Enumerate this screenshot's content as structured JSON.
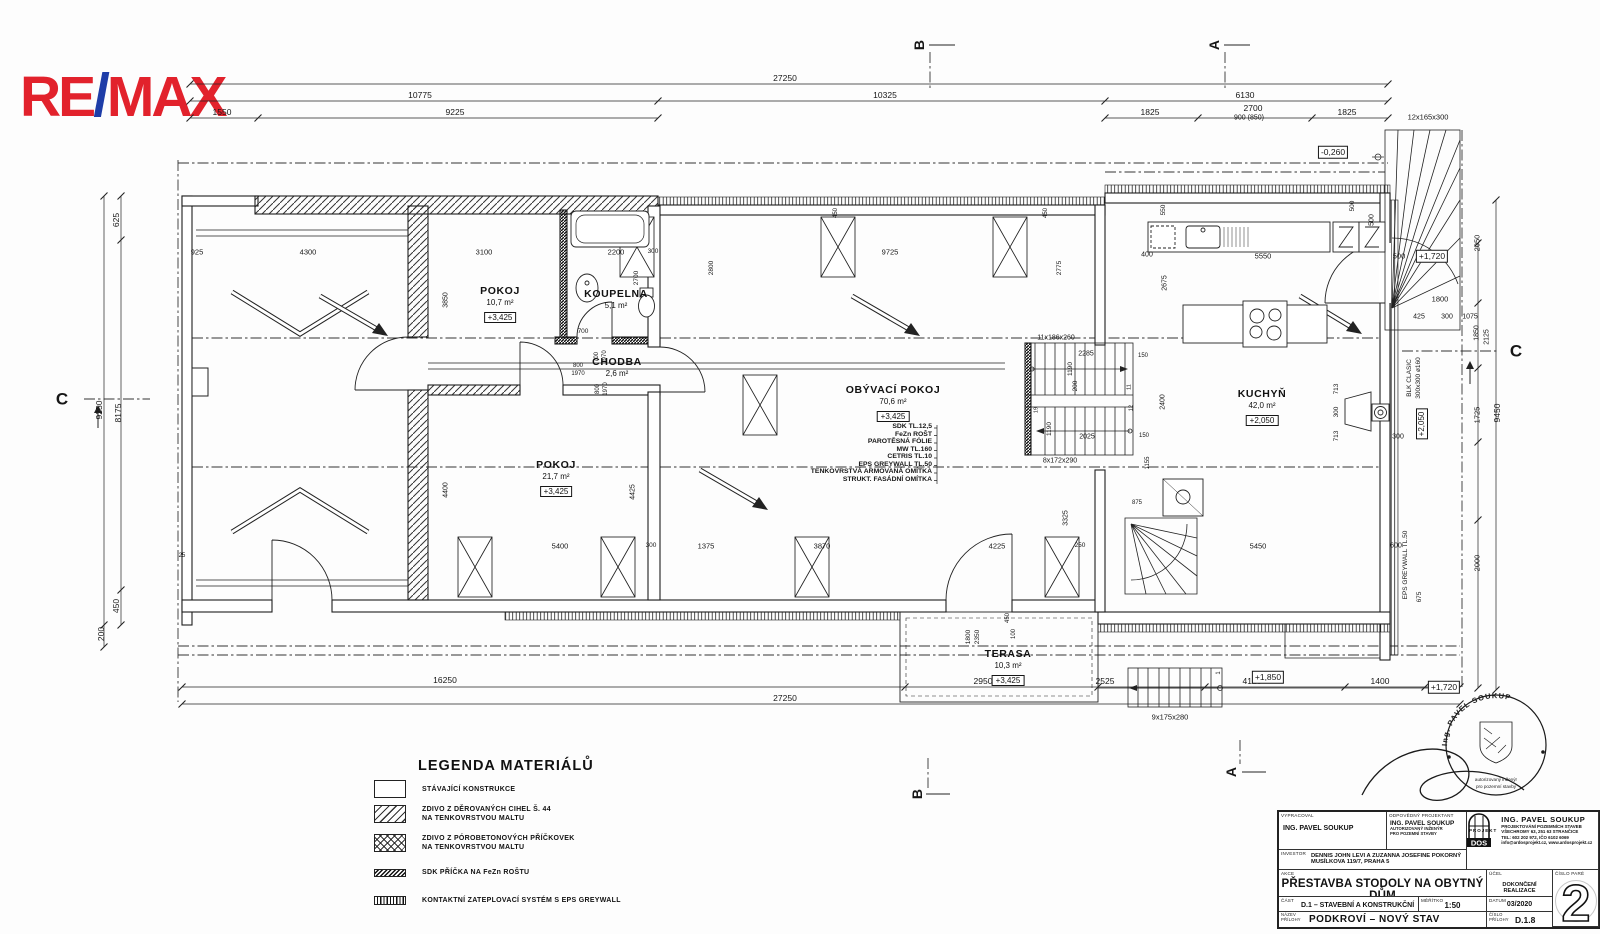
{
  "logo": {
    "re": "RE",
    "slash": "/",
    "max": "MAX",
    "red": "#e2222c",
    "blue": "#1e3da8"
  },
  "legend": {
    "title": "LEGENDA MATERIÁLŮ",
    "items": [
      {
        "swatch": "plain",
        "line1": "STÁVAJÍCÍ KONSTRUKCE",
        "line2": ""
      },
      {
        "swatch": "diag",
        "line1": "ZDIVO Z DĚROVANÝCH CIHEL Š. 44",
        "line2": "NA TENKOVRSTVOU MALTU"
      },
      {
        "swatch": "cross",
        "line1": "ZDIVO Z PÓROBETONOVÝCH PŘÍČKOVEK",
        "line2": "NA TENKOVRSTVOU MALTU"
      },
      {
        "swatch": "sdk",
        "line1": "SDK PŘÍČKA NA FeZn ROŠTU",
        "line2": ""
      },
      {
        "swatch": "eps",
        "line1": "KONTAKTNÍ ZATEPLOVACÍ SYSTÉM S EPS GREYWALL",
        "line2": ""
      }
    ]
  },
  "title_block": {
    "lbl_vypracoval": "VYPRACOVAL",
    "vypracoval": "ING. PAVEL SOUKUP",
    "lbl_odpovedny": "ODPOVĚDNÝ PROJEKTANT",
    "odpovedny": "ING. PAVEL SOUKUP",
    "odpovedny_note1": "AUTORIZOVANÝ INŽENÝR",
    "odpovedny_note2": "PRO POZEMNÍ STAVBY",
    "lbl_investor": "INVESTOR",
    "investor1": "DENNIS JOHN LEVI A ZUZANNA JOSEFINE POKORNÝ",
    "investor2": "MUSÍLKOVA 119/7, PRAHA 5",
    "lbl_akce": "AKCE",
    "akce": "PŘESTAVBA STODOLY NA OBYTNÝ DŮM",
    "akce_sub": "KOSTELNÍ STŘÍMELICE č.p. 12, parc.č. st.12",
    "lbl_ucel": "ÚČEL",
    "ucel": "DOKONČENÍ REALIZACE",
    "lbl_cast": "ČÁST",
    "cast": "D.1 – STAVEBNÍ A KONSTRUKČNÍ",
    "lbl_meritko": "MĚŘÍTKO",
    "meritko": "1:50",
    "lbl_datum": "DATUM",
    "datum": "03/2020",
    "lbl_nazev1": "NÁZEV",
    "lbl_nazev2": "PŘÍLOHY",
    "nazev": "PODKROVÍ – NOVÝ STAV",
    "lbl_cislo1": "ČÍSLO",
    "lbl_cislo2": "PŘÍLOHY",
    "cislo": "D.1.8",
    "lbl_pare": "ČÍSLO PARÉ",
    "pare": "2",
    "dos": {
      "logo_top": "DOS",
      "logo_bottom": "PROJEKT",
      "name": "ING. PAVEL SOUKUP",
      "l1": "PROJEKTOVÁNÍ POZEMNÍCH STAVEB",
      "l2": "VŠECHROMY 63, 251 63 STRANČICE",
      "l3": "TEL: 602 202 972, IČO 6102 6069",
      "l4": "info@ardosprojekt.cz, www.ardosprojekt.cz"
    }
  },
  "stamp": {
    "arc": "Ing. PAVEL SOUKUP",
    "line1": "autorizovaný inženýr",
    "line2": "pro pozemní stavby"
  },
  "plan": {
    "layers": [
      "SDK TL.12,5",
      "FeZn ROŠT",
      "PAROTĚSNÁ FÓLIE",
      "MW TL.160",
      "CETRIS TL.10",
      "EPS GREYWALL TL.50",
      "TENKOVRSTVÁ ARMOVANÁ OMÍTKA",
      "STRUKT. FASÁDNÍ OMÍTKA"
    ],
    "rooms": [
      {
        "name": "POKOJ",
        "area": "10,7 m²",
        "level": "+3,425",
        "x": 500,
        "y": 291
      },
      {
        "name": "KOUPELNA",
        "area": "5,1 m²",
        "level": "",
        "x": 616,
        "y": 294
      },
      {
        "name": "CHODBA",
        "area": "2,6 m²",
        "level": "",
        "x": 617,
        "y": 362
      },
      {
        "name": "POKOJ",
        "area": "21,7 m²",
        "level": "+3,425",
        "x": 556,
        "y": 465
      },
      {
        "name": "OBÝVACÍ POKOJ",
        "area": "70,6 m²",
        "level": "+3,425",
        "x": 893,
        "y": 390
      },
      {
        "name": "KUCHYŇ",
        "area": "42,0 m²",
        "level": "+2,050",
        "x": 1262,
        "y": 394
      },
      {
        "name": "TERASA",
        "area": "10,3 m²",
        "level": "+3,425",
        "x": 1008,
        "y": 654
      }
    ],
    "labels": [
      {
        "t": "27250",
        "x": 785,
        "y": 78
      },
      {
        "t": "10775",
        "x": 420,
        "y": 95
      },
      {
        "t": "10325",
        "x": 885,
        "y": 95
      },
      {
        "t": "6130",
        "x": 1245,
        "y": 95
      },
      {
        "t": "1550",
        "x": 222,
        "y": 112
      },
      {
        "t": "9225",
        "x": 455,
        "y": 112
      },
      {
        "t": "1825",
        "x": 1150,
        "y": 112
      },
      {
        "t": "2700",
        "x": 1253,
        "y": 108
      },
      {
        "t": "900 (850)",
        "x": 1249,
        "y": 118,
        "fs": 7
      },
      {
        "t": "1825",
        "x": 1347,
        "y": 112
      },
      {
        "t": "12x165x300",
        "x": 1428,
        "y": 117,
        "fs": 7.5
      },
      {
        "t": "-0,260",
        "x": 1333,
        "y": 152,
        "b": 1
      },
      {
        "t": "B",
        "x": 919,
        "y": 45,
        "r": 1,
        "bold": 1,
        "fs": 14,
        "n": "section-marker-b-top"
      },
      {
        "t": "A",
        "x": 1214,
        "y": 45,
        "r": 1,
        "bold": 1,
        "fs": 14,
        "n": "section-marker-a-top"
      },
      {
        "t": "A",
        "x": 1231,
        "y": 772,
        "r": 1,
        "bold": 1,
        "fs": 14,
        "n": "section-marker-a-bottom"
      },
      {
        "t": "B",
        "x": 917,
        "y": 794,
        "r": 1,
        "bold": 1,
        "fs": 14,
        "n": "section-marker-b-bottom"
      },
      {
        "t": "C",
        "x": 62,
        "y": 399,
        "bold": 1,
        "fs": 17,
        "n": "section-marker-c-left"
      },
      {
        "t": "C",
        "x": 1516,
        "y": 351,
        "bold": 1,
        "fs": 17,
        "n": "section-marker-c-right"
      },
      {
        "t": "625",
        "x": 116,
        "y": 220,
        "r": 1
      },
      {
        "t": "9250",
        "x": 99,
        "y": 410,
        "r": 1
      },
      {
        "t": "8175",
        "x": 118,
        "y": 413,
        "r": 1
      },
      {
        "t": "450",
        "x": 116,
        "y": 606,
        "r": 1
      },
      {
        "t": "200",
        "x": 101,
        "y": 634,
        "r": 1
      },
      {
        "t": "2050",
        "x": 1477,
        "y": 243,
        "r": 1,
        "fs": 7.5
      },
      {
        "t": "500",
        "x": 1372,
        "y": 220,
        "r": 1,
        "fs": 7
      },
      {
        "t": "500",
        "x": 1399,
        "y": 256,
        "fs": 7.5
      },
      {
        "t": "+1,720",
        "x": 1432,
        "y": 256,
        "b": 1
      },
      {
        "t": "1800",
        "x": 1440,
        "y": 299,
        "fs": 7.5
      },
      {
        "t": "425",
        "x": 1419,
        "y": 317,
        "fs": 7
      },
      {
        "t": "300",
        "x": 1447,
        "y": 317,
        "fs": 7
      },
      {
        "t": "1075",
        "x": 1470,
        "y": 317,
        "fs": 7
      },
      {
        "t": "1850",
        "x": 1477,
        "y": 333,
        "r": 1,
        "fs": 7
      },
      {
        "t": "2125",
        "x": 1487,
        "y": 337,
        "r": 1,
        "fs": 7
      },
      {
        "t": "1725",
        "x": 1477,
        "y": 415,
        "r": 1,
        "fs": 7.5
      },
      {
        "t": "9450",
        "x": 1497,
        "y": 413,
        "r": 1
      },
      {
        "t": "BLK CLASIC",
        "x": 1410,
        "y": 378,
        "r": 1,
        "fs": 6.5
      },
      {
        "t": "300x300 ø160",
        "x": 1419,
        "y": 378,
        "r": 1,
        "fs": 6.5
      },
      {
        "t": "+2,050",
        "x": 1422,
        "y": 424,
        "r": 1,
        "b": 1,
        "fs": 8
      },
      {
        "t": "300",
        "x": 1398,
        "y": 437,
        "fs": 7
      },
      {
        "t": "713",
        "x": 1337,
        "y": 389,
        "r": 1,
        "fs": 6.5
      },
      {
        "t": "300",
        "x": 1337,
        "y": 412,
        "r": 1,
        "fs": 6.5
      },
      {
        "t": "713",
        "x": 1337,
        "y": 436,
        "r": 1,
        "fs": 6.5
      },
      {
        "t": "EPS GREYWALL TL.50",
        "x": 1406,
        "y": 565,
        "r": 1,
        "fs": 6.5
      },
      {
        "t": "2000",
        "x": 1477,
        "y": 563,
        "r": 1,
        "fs": 7.5
      },
      {
        "t": "675",
        "x": 1420,
        "y": 597,
        "r": 1,
        "fs": 6.5
      },
      {
        "t": "16250",
        "x": 445,
        "y": 680
      },
      {
        "t": "2950",
        "x": 983,
        "y": 681
      },
      {
        "t": "2525",
        "x": 1105,
        "y": 681
      },
      {
        "t": "4125",
        "x": 1252,
        "y": 681
      },
      {
        "t": "1400",
        "x": 1380,
        "y": 681
      },
      {
        "t": "27250",
        "x": 785,
        "y": 698
      },
      {
        "t": "+1,850",
        "x": 1268,
        "y": 677,
        "b": 1
      },
      {
        "t": "+1,720",
        "x": 1444,
        "y": 687,
        "b": 1
      },
      {
        "t": "9x175x280",
        "x": 1170,
        "y": 717,
        "fs": 7.5
      },
      {
        "t": "1800",
        "x": 969,
        "y": 637,
        "r": 1,
        "fs": 6.5
      },
      {
        "t": "2350",
        "x": 978,
        "y": 637,
        "r": 1,
        "fs": 6.5
      },
      {
        "t": "100",
        "x": 1014,
        "y": 634,
        "r": 1,
        "fs": 6
      },
      {
        "t": "450",
        "x": 1008,
        "y": 618,
        "r": 1,
        "fs": 6
      },
      {
        "t": "925",
        "x": 197,
        "y": 252,
        "fs": 7.5
      },
      {
        "t": "4300",
        "x": 308,
        "y": 252,
        "fs": 7.5
      },
      {
        "t": "3100",
        "x": 484,
        "y": 252,
        "fs": 7.5
      },
      {
        "t": "2200",
        "x": 616,
        "y": 252,
        "fs": 7.5
      },
      {
        "t": "300",
        "x": 653,
        "y": 252,
        "fs": 6.5
      },
      {
        "t": "9725",
        "x": 890,
        "y": 252,
        "fs": 7.5
      },
      {
        "t": "450",
        "x": 836,
        "y": 213,
        "r": 1,
        "fs": 6
      },
      {
        "t": "450",
        "x": 1046,
        "y": 213,
        "r": 1,
        "fs": 6
      },
      {
        "t": "2800",
        "x": 712,
        "y": 268,
        "r": 1,
        "fs": 6.5
      },
      {
        "t": "2775",
        "x": 1060,
        "y": 268,
        "r": 1,
        "fs": 6.5
      },
      {
        "t": "2675",
        "x": 1165,
        "y": 283,
        "r": 1,
        "fs": 7
      },
      {
        "t": "400",
        "x": 1147,
        "y": 255,
        "fs": 7
      },
      {
        "t": "5550",
        "x": 1263,
        "y": 256,
        "fs": 7.5
      },
      {
        "t": "550",
        "x": 1164,
        "y": 210,
        "r": 1,
        "fs": 6.5
      },
      {
        "t": "500",
        "x": 1353,
        "y": 206,
        "r": 1,
        "fs": 6.5
      },
      {
        "t": "2400",
        "x": 1163,
        "y": 402,
        "r": 1,
        "fs": 7
      },
      {
        "t": "3850",
        "x": 446,
        "y": 300,
        "r": 1,
        "fs": 7
      },
      {
        "t": "2700",
        "x": 637,
        "y": 278,
        "r": 1,
        "fs": 6.5
      },
      {
        "t": "4400",
        "x": 446,
        "y": 490,
        "r": 1,
        "fs": 7
      },
      {
        "t": "4425",
        "x": 633,
        "y": 492,
        "r": 1,
        "fs": 7
      },
      {
        "t": "700",
        "x": 583,
        "y": 332,
        "fs": 6.5
      },
      {
        "t": "800",
        "x": 578,
        "y": 366,
        "fs": 6
      },
      {
        "t": "1970",
        "x": 578,
        "y": 374,
        "fs": 6
      },
      {
        "t": "700",
        "x": 597,
        "y": 357,
        "r": 1,
        "fs": 6
      },
      {
        "t": "1970",
        "x": 605,
        "y": 357,
        "r": 1,
        "fs": 6
      },
      {
        "t": "800",
        "x": 598,
        "y": 389,
        "r": 1,
        "fs": 6
      },
      {
        "t": "1970",
        "x": 606,
        "y": 389,
        "r": 1,
        "fs": 6
      },
      {
        "t": "11x186x260",
        "x": 1056,
        "y": 338,
        "fs": 7
      },
      {
        "t": "2285",
        "x": 1086,
        "y": 354,
        "fs": 7
      },
      {
        "t": "1190",
        "x": 1071,
        "y": 369,
        "r": 1,
        "fs": 6.5
      },
      {
        "t": "200",
        "x": 1076,
        "y": 386,
        "r": 1,
        "fs": 6.5
      },
      {
        "t": "2025",
        "x": 1087,
        "y": 437,
        "fs": 7
      },
      {
        "t": "1190",
        "x": 1050,
        "y": 429,
        "r": 1,
        "fs": 6.5
      },
      {
        "t": "8x172x290",
        "x": 1060,
        "y": 461,
        "fs": 7
      },
      {
        "t": "150",
        "x": 1143,
        "y": 356,
        "fs": 6
      },
      {
        "t": "150",
        "x": 1144,
        "y": 436,
        "fs": 6
      },
      {
        "t": "19",
        "x": 1037,
        "y": 410,
        "r": 1,
        "fs": 5.5
      },
      {
        "t": "11",
        "x": 1130,
        "y": 387,
        "r": 1,
        "fs": 5.5
      },
      {
        "t": "12",
        "x": 1132,
        "y": 408,
        "r": 1,
        "fs": 5.5
      },
      {
        "t": "1",
        "x": 1219,
        "y": 673,
        "r": 1,
        "fs": 6
      },
      {
        "t": "5400",
        "x": 560,
        "y": 546,
        "fs": 7.5
      },
      {
        "t": "300",
        "x": 651,
        "y": 546,
        "fs": 6.5
      },
      {
        "t": "1375",
        "x": 706,
        "y": 546,
        "fs": 7.5
      },
      {
        "t": "3870",
        "x": 822,
        "y": 546,
        "fs": 7.5
      },
      {
        "t": "4225",
        "x": 997,
        "y": 546,
        "fs": 7.5
      },
      {
        "t": "250",
        "x": 1080,
        "y": 546,
        "fs": 6.5
      },
      {
        "t": "5450",
        "x": 1258,
        "y": 546,
        "fs": 7.5
      },
      {
        "t": "600",
        "x": 1396,
        "y": 546,
        "fs": 7
      },
      {
        "t": "875",
        "x": 1137,
        "y": 503,
        "fs": 6
      },
      {
        "t": "3325",
        "x": 1066,
        "y": 518,
        "r": 1,
        "fs": 7
      },
      {
        "t": "1155",
        "x": 1148,
        "y": 463,
        "r": 1,
        "fs": 6
      },
      {
        "t": "25",
        "x": 182,
        "y": 556,
        "fs": 6
      }
    ]
  }
}
